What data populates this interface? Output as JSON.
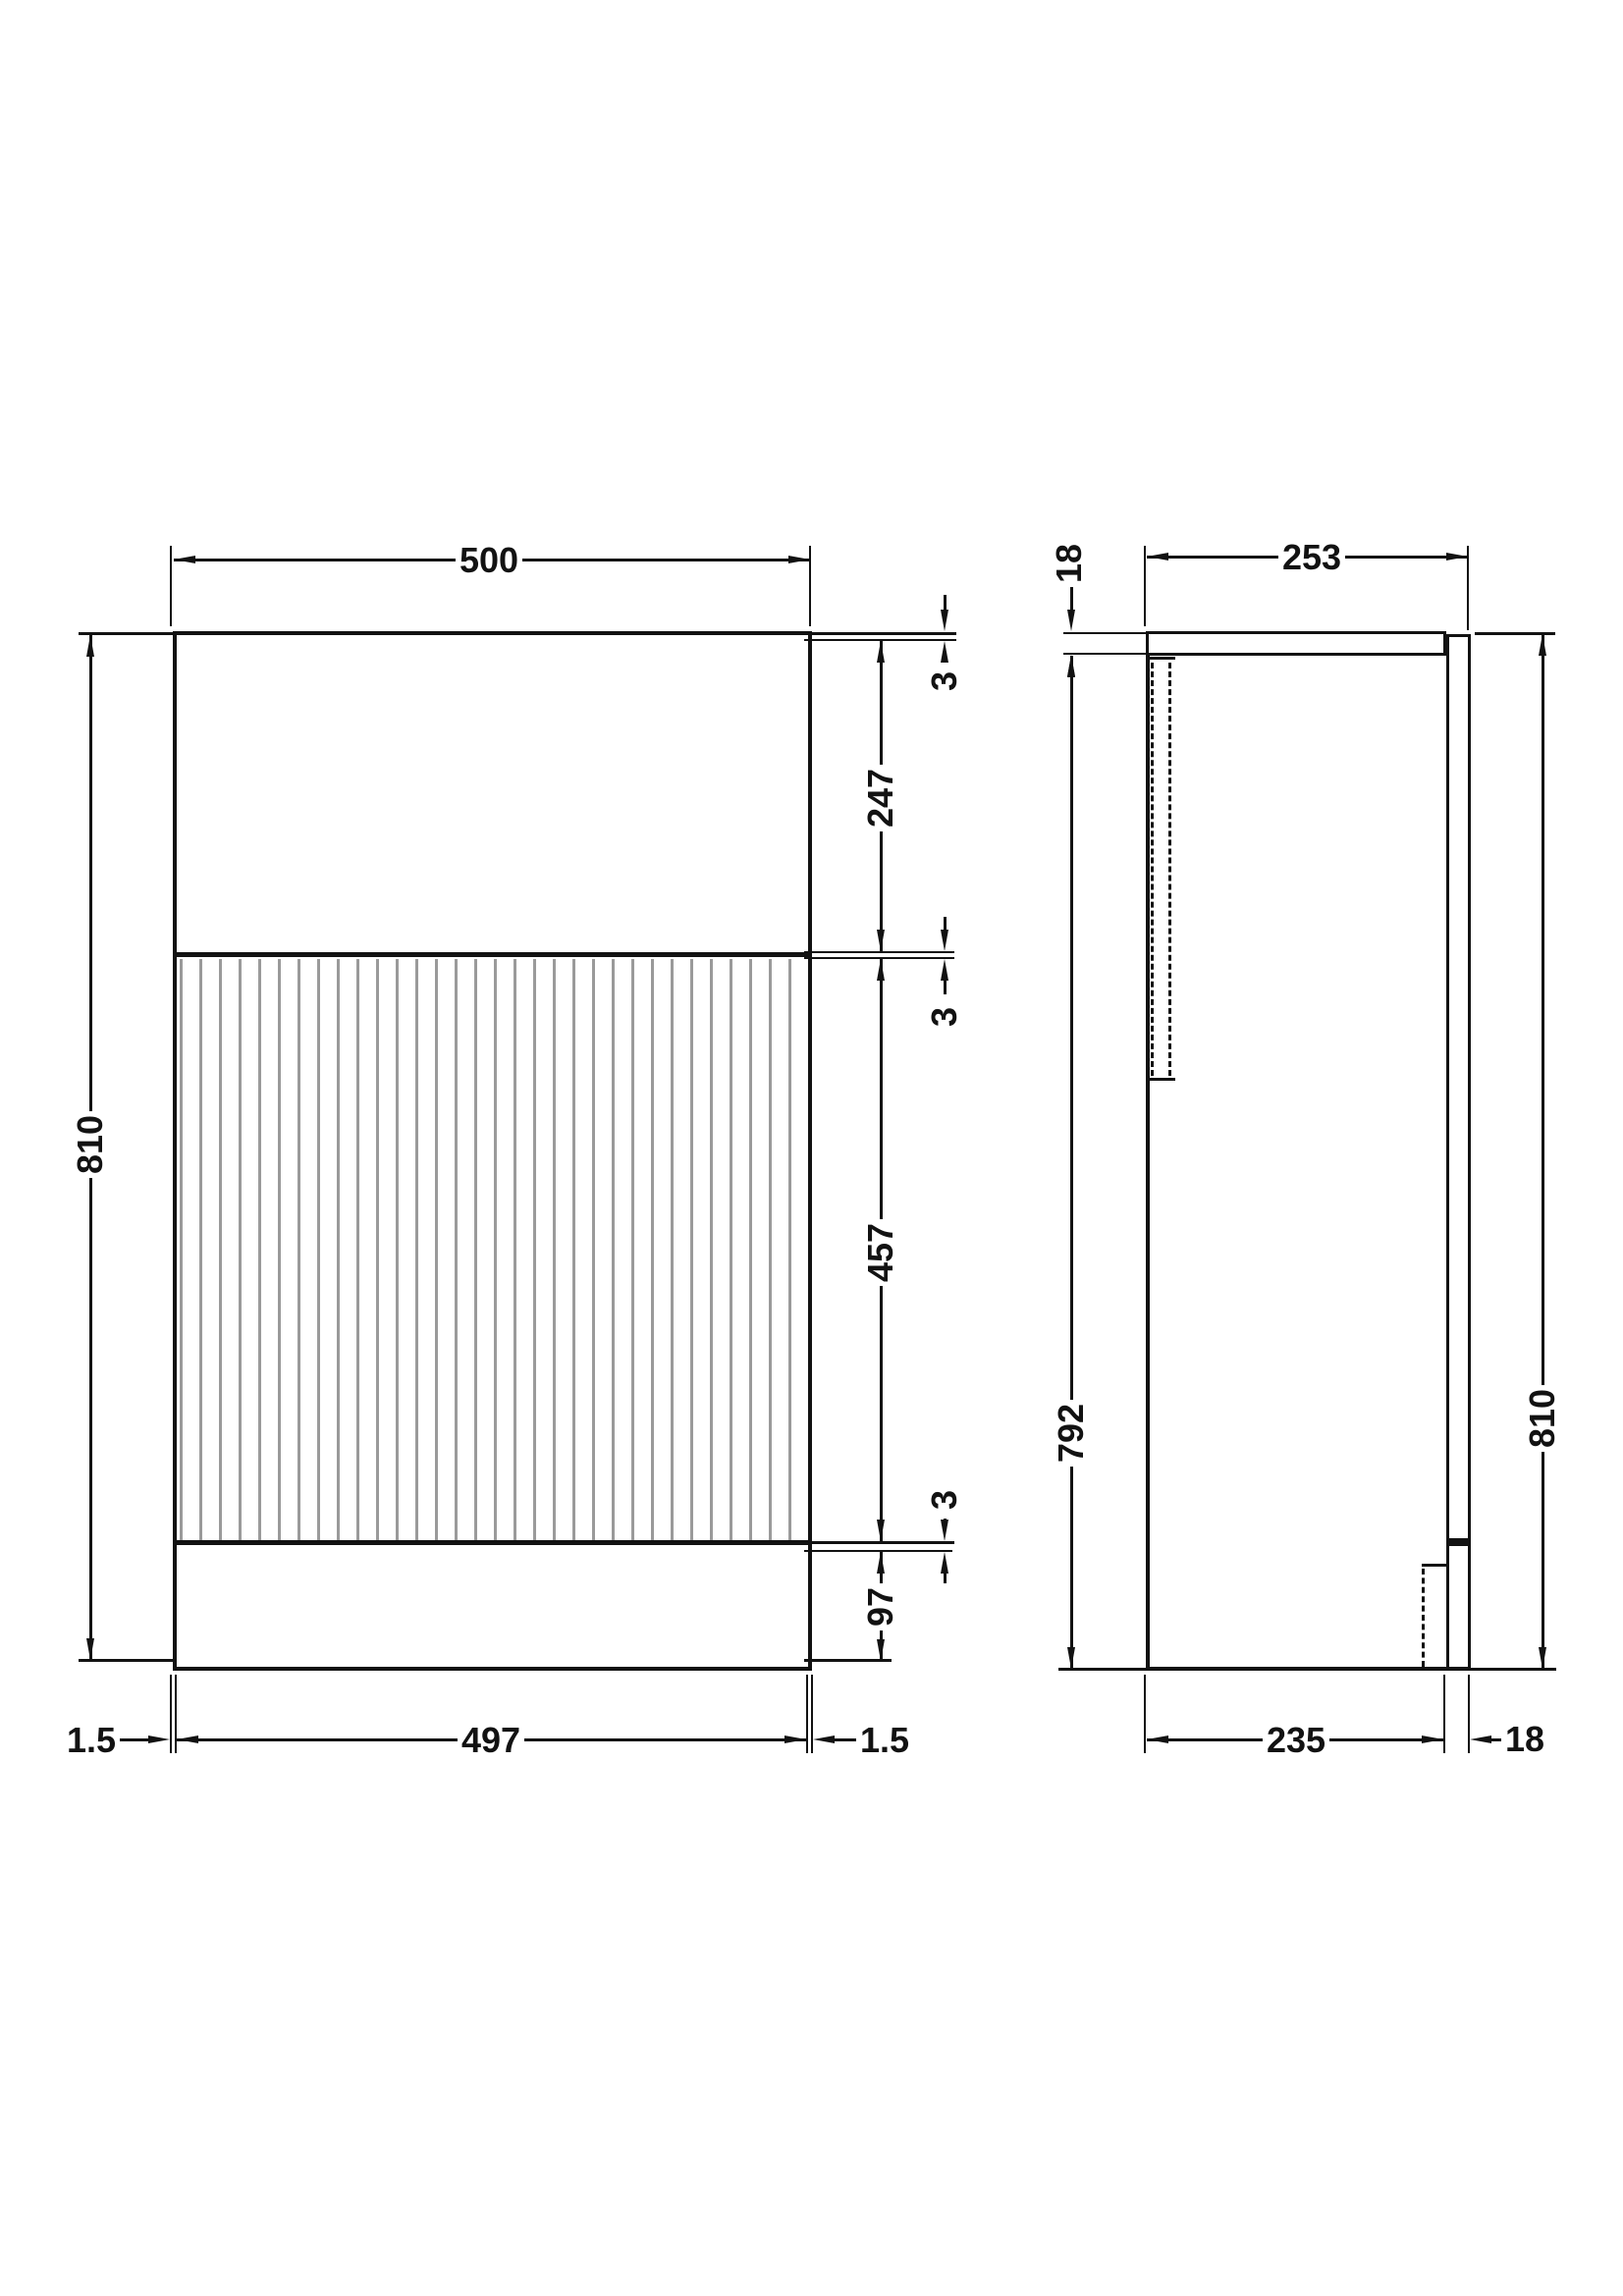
{
  "drawing_type": "cabinet technical drawing, front and side elevations with millimetre dimensions",
  "front": {
    "dims": {
      "overall_width": "500",
      "overall_height": "810",
      "gap_top": "3",
      "upper_panel_height": "247",
      "gap_middle": "3",
      "fluted_door_height": "457",
      "gap_bottom": "3",
      "plinth_height": "97",
      "edge_left": "1.5",
      "door_width": "497",
      "edge_right": "1.5"
    }
  },
  "side": {
    "dims": {
      "worktop_thickness": "18",
      "overall_depth": "253",
      "carcass_height": "792",
      "overall_height": "810",
      "carcass_depth": "235",
      "back_panel_thickness": "18"
    }
  },
  "style": {
    "line_color": "#121212",
    "flute_color": "#9a9a9a",
    "background": "#ffffff"
  }
}
